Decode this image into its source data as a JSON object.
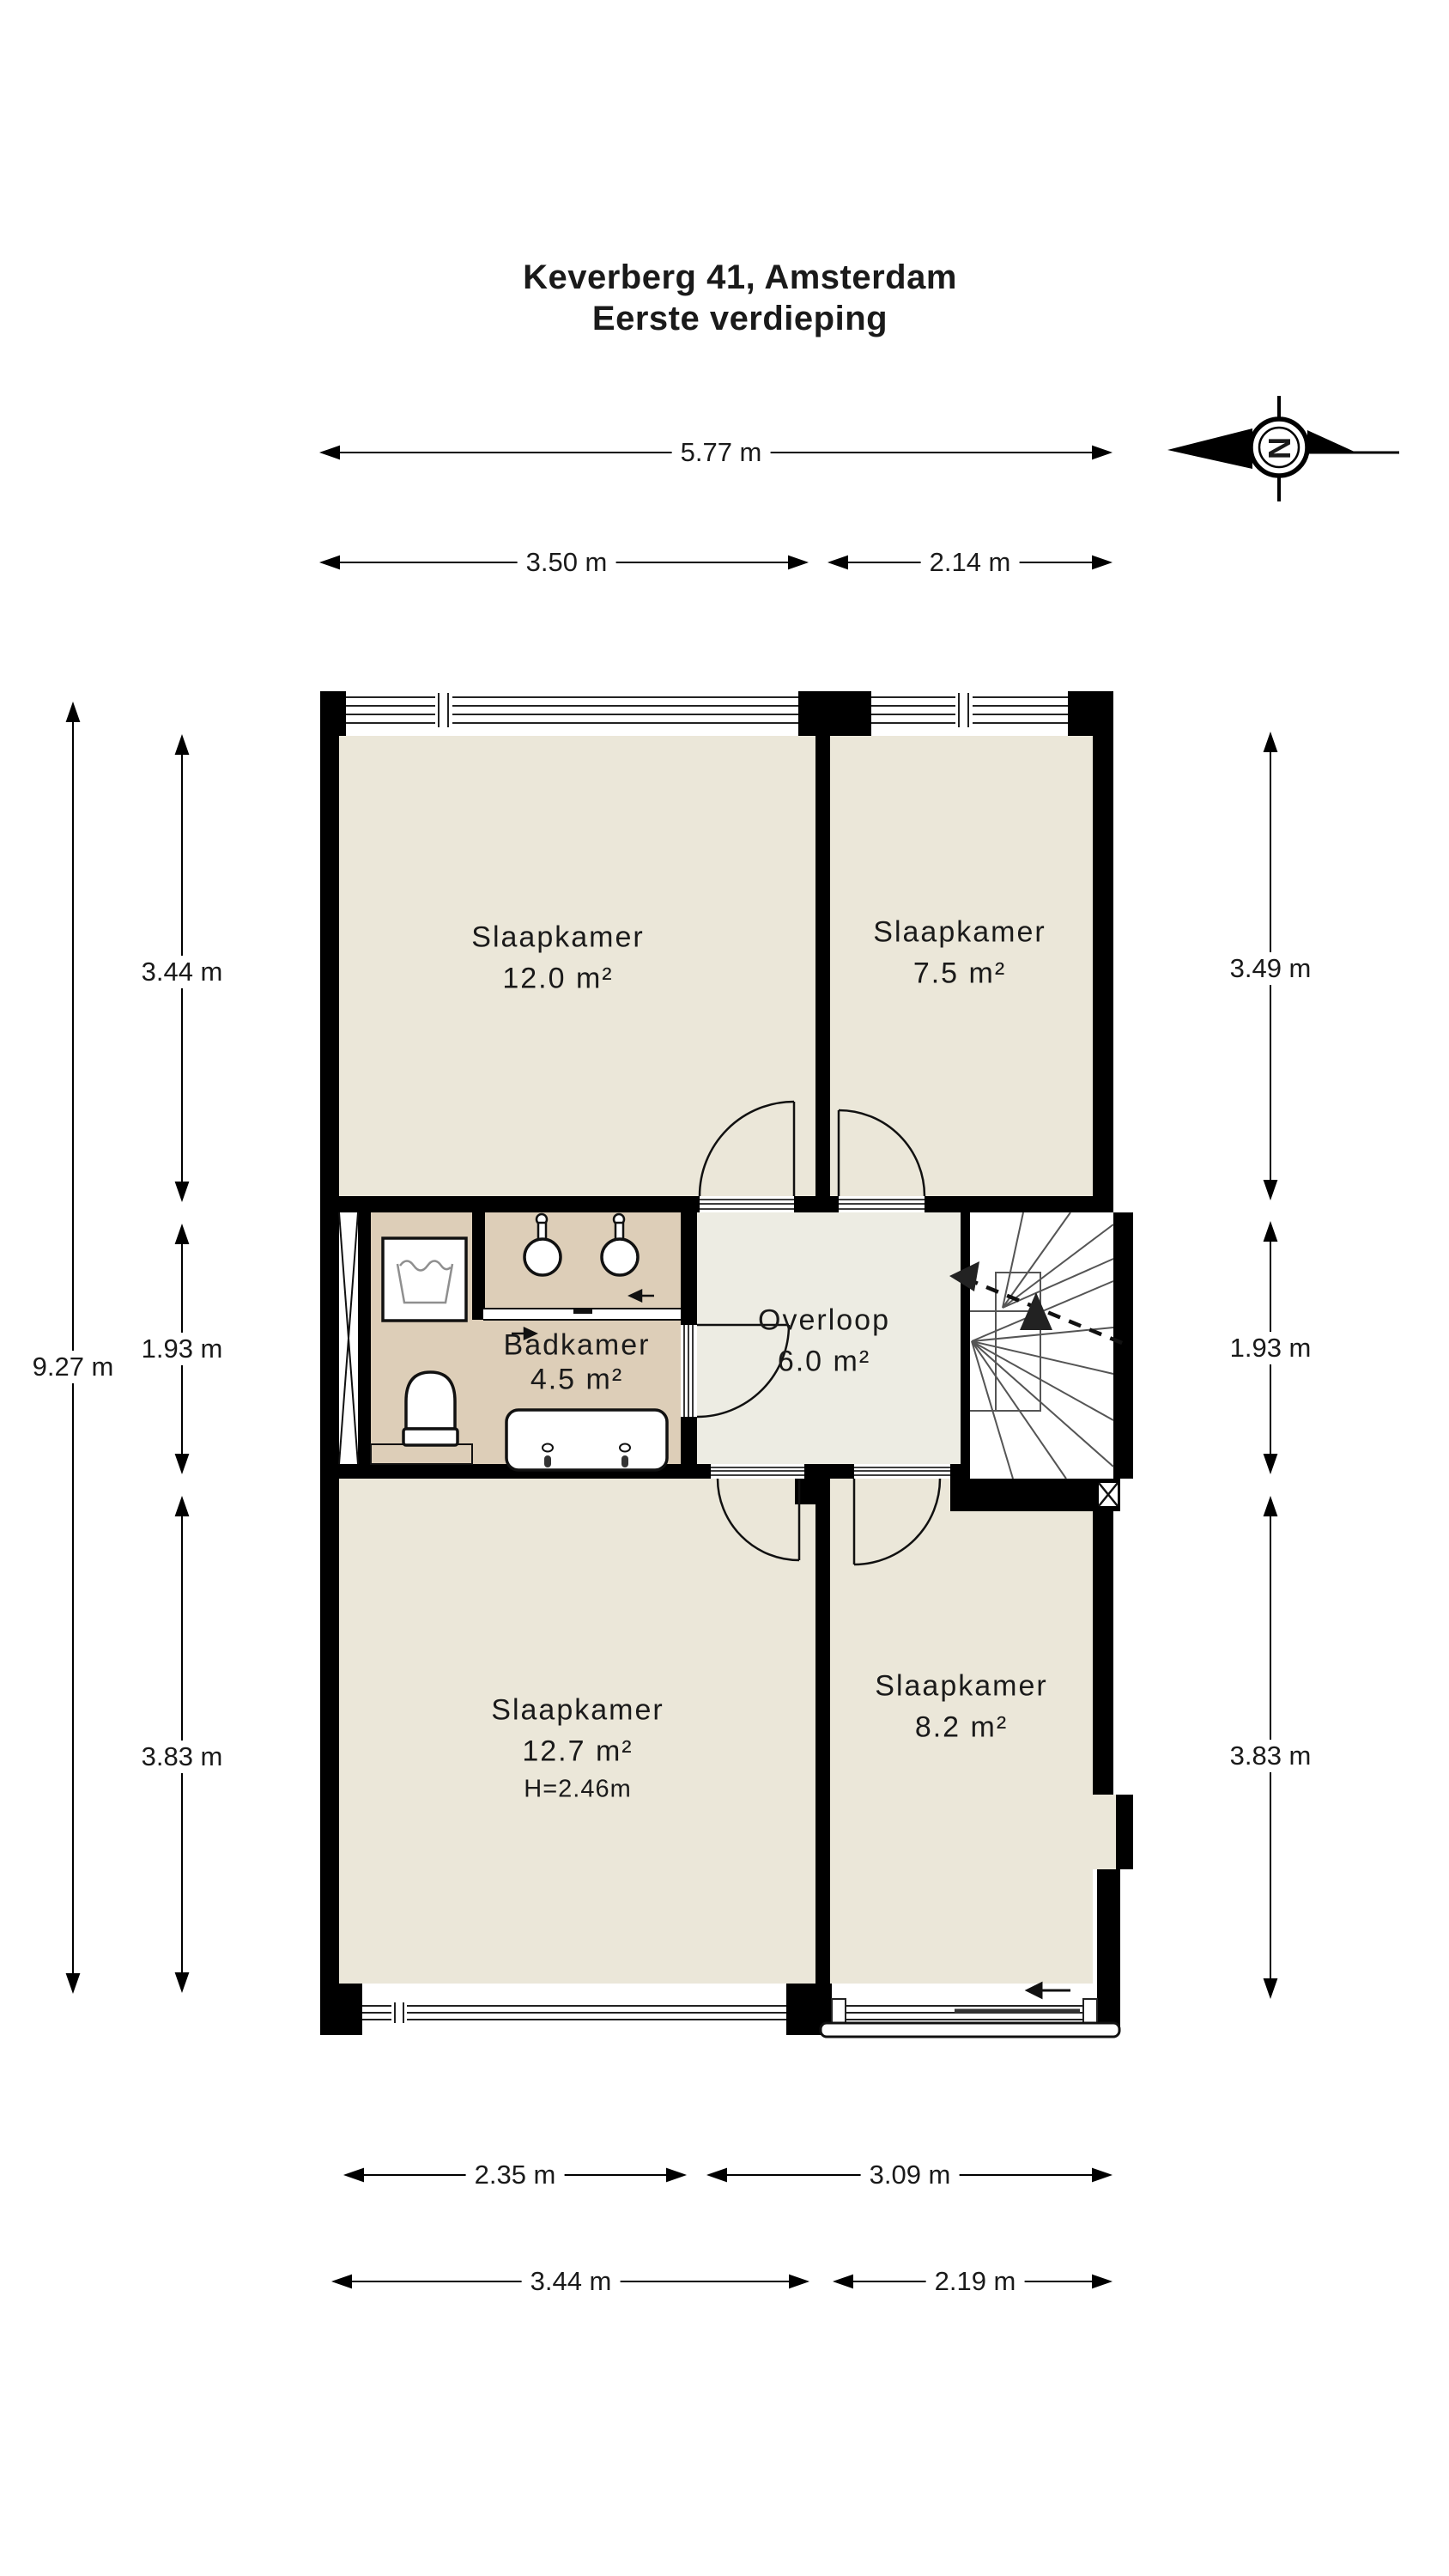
{
  "title": {
    "line1": "Keverberg 41, Amsterdam",
    "line2": "Eerste verdieping"
  },
  "compass": {
    "letter": "N"
  },
  "rooms": {
    "bedroom_top_left": {
      "name": "Slaapkamer",
      "area": "12.0 m²"
    },
    "bedroom_top_right": {
      "name": "Slaapkamer",
      "area": "7.5 m²"
    },
    "bathroom": {
      "name": "Badkamer",
      "area": "4.5 m²"
    },
    "landing": {
      "name": "Overloop",
      "area": "6.0 m²"
    },
    "bedroom_bottom_left": {
      "name": "Slaapkamer",
      "area": "12.7 m²",
      "ceiling_height": "H=2.46m"
    },
    "bedroom_bottom_right": {
      "name": "Slaapkamer",
      "area": "8.2 m²"
    }
  },
  "dimensions": {
    "top_total": "5.77 m",
    "top_left": "3.50 m",
    "top_right": "2.14 m",
    "bottom_inner_left": "2.35 m",
    "bottom_inner_right": "3.09 m",
    "bottom_outer_left": "3.44 m",
    "bottom_outer_right": "2.19 m",
    "left_total": "9.27 m",
    "left_top": "3.44 m",
    "left_middle": "1.93 m",
    "left_bottom": "3.83 m",
    "right_top": "3.49 m",
    "right_middle": "1.93 m",
    "right_bottom": "3.83 m"
  },
  "colors": {
    "wall": "#000000",
    "bedroom_floor": "#ebe7d9",
    "bathroom_floor": "#ddceb8",
    "landing_floor": "#edece3",
    "stair_floor": "#ffffff",
    "background": "#ffffff"
  }
}
